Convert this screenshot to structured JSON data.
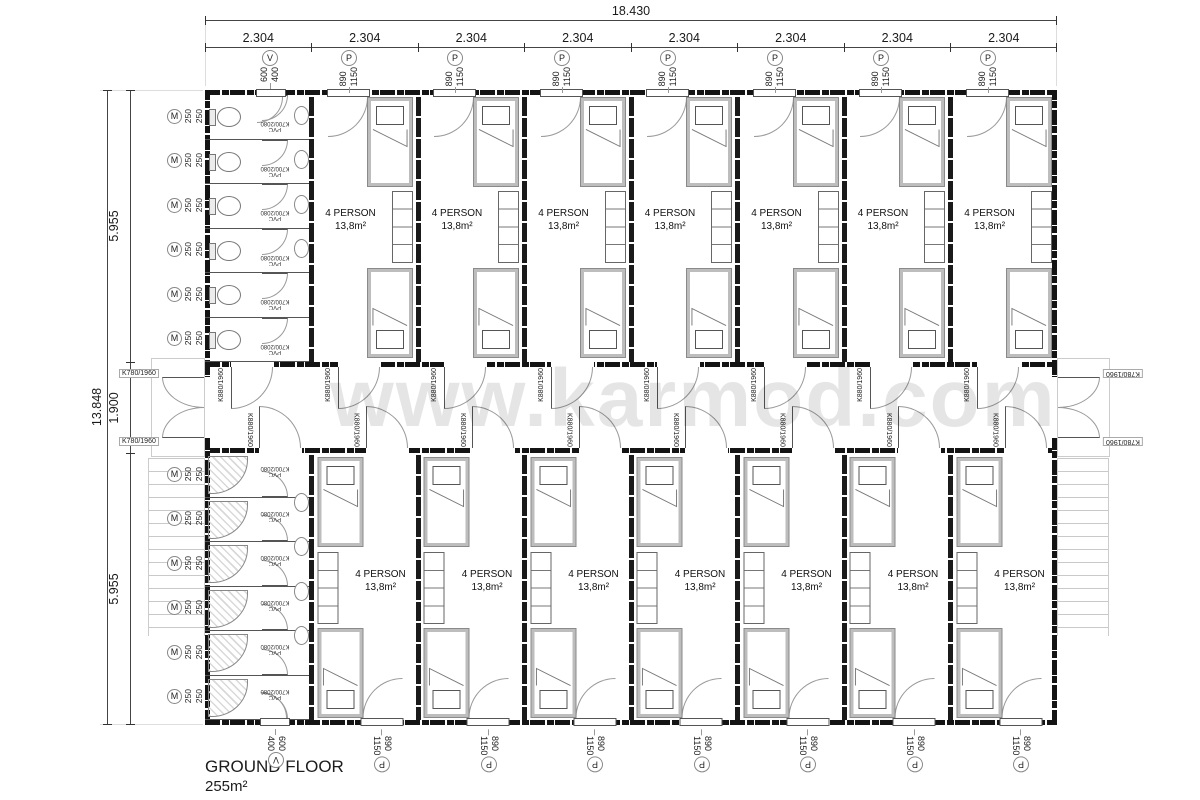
{
  "watermark": "www.karmod.com",
  "title": {
    "name": "GROUND FLOOR",
    "area": "255m²"
  },
  "dims": {
    "total_width": "18.430",
    "segments": [
      "2.304",
      "2.304",
      "2.304",
      "2.304",
      "2.304",
      "2.304",
      "2.304",
      "2.304"
    ],
    "total_height": "13.848",
    "sections": [
      "5.955",
      "1.900",
      "5.955"
    ]
  },
  "room": {
    "label": "4 PERSON",
    "area": "13,8m²"
  },
  "doors": {
    "interior": "K880/1960",
    "exterior": "K780/1960",
    "cabin_material": "PVC",
    "cabin_size": "K700/2080"
  },
  "openings": {
    "window": {
      "tag": "P",
      "width": "890",
      "height": "1150"
    },
    "vent": {
      "tag": "V",
      "width": "600",
      "height": "400"
    },
    "panel": {
      "tag": "M",
      "width": "250",
      "height": "250"
    }
  }
}
